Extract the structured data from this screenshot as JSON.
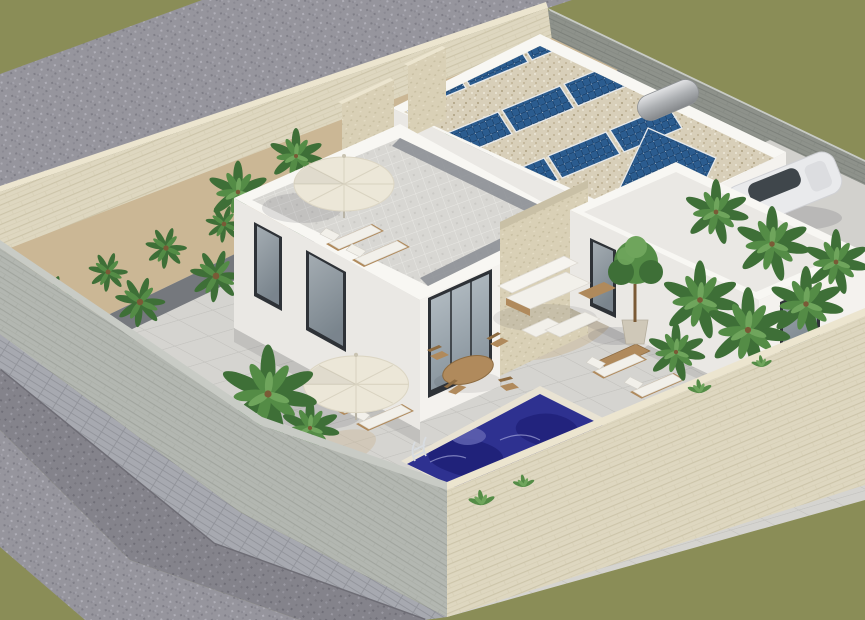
{
  "scene": {
    "type": "3d-architectural-render",
    "view": "aerial-isometric",
    "description": "Modern white Mediterranean villa with rooftop solar panels, a roof terrace with parasol and sun loungers, palm-lined walled garden, patio furniture and a private swimming pool, surrounded by stone boundary walls and gravel streets on an olive-green ground."
  },
  "palette": {
    "olive": "#8a8d57",
    "gravel": "#96959d",
    "gravelDark": "#84838b",
    "paver": "#a7a9b0",
    "curb": "#6e6d75",
    "creamWall": "#ded7c0",
    "creamCap": "#ece5cf",
    "creamLine": "#cdc5aa",
    "grayWall": "#b3b7b1",
    "grayLine": "#a1a59e",
    "grayCap": "#c8cbc5",
    "darkWall": "#8e928b",
    "darkLine": "#7c807a",
    "sand": "#cbb795",
    "pathTile": "#75787d",
    "tile": "#d5d4d0",
    "tileLine": "#c4c3bf",
    "terr": "#d8d7d3",
    "terrLine": "#e8e7e3",
    "terrBorder": "#8a8d93",
    "white1": "#f4f2ee",
    "white2": "#eae8e4",
    "white3": "#dddcd8",
    "parapet": "#f8f7f3",
    "glassFrame": "#2e3237",
    "glassA": "#b9c2c8",
    "glassB": "#87939c",
    "panelBase": "#2b5c8f",
    "panelDark": "#16375c",
    "panelFrame": "#e8eaec",
    "roofGravel": "#d8cfb9",
    "roofDot1": "#c5b99e",
    "roofDot2": "#e7e1d0",
    "stone": "#d9d0b6",
    "stoneLine": "#c8bfa2",
    "pool1": "#2e3190",
    "pool2": "#1f2178",
    "pool3": "#5f61b0",
    "pool4": "#a3a5d8",
    "coping": "#e9e3d3",
    "wood": "#b08a5c",
    "woodDark": "#8d6b41",
    "cushion": "#f2f0ea",
    "canvasCream": "#ece7d8",
    "green1": "#3e6f37",
    "green2": "#548c46",
    "green3": "#6fa55c",
    "trunk": "#7a5a36",
    "hedge": "#3c6e35",
    "flower": "#e3d45c",
    "flower2": "#e0995a",
    "carBody": "#e9eaec",
    "carGlass": "#3f464b",
    "drive": "#d2d1cd",
    "shadow": "#2e2e3a",
    "metal": "#d8dce0"
  },
  "objects": {
    "buildings": {
      "count": 3,
      "style": "white flat-roof modern villa"
    },
    "solar_panels": {
      "count": 12,
      "color": "#2b5c8f"
    },
    "solar_water_heater": {
      "count": 1
    },
    "roof_terrace": {
      "count": 1
    },
    "parasols": {
      "count": 2,
      "color": "#ece7d8"
    },
    "sun_loungers": {
      "count": 6
    },
    "dining_tables": {
      "count": 1
    },
    "dining_chairs": {
      "count": 4
    },
    "sofas": {
      "count": 1
    },
    "coffee_tables": {
      "count": 2
    },
    "potted_trees": {
      "count": 1
    },
    "palm_trees": {
      "count": 22
    },
    "swimming_pool": {
      "count": 1,
      "ladder": true,
      "color": "#2e3190"
    },
    "car": {
      "count": 1,
      "color": "#e9eaec"
    },
    "boundary_walls": {
      "count": 4
    }
  }
}
